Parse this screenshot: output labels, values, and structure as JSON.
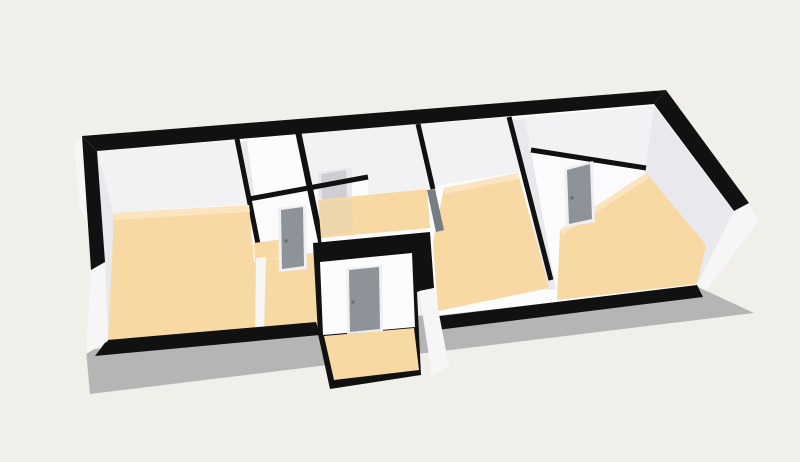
{
  "view": {
    "kind": "3d-floor-plan-render",
    "camera": "perspective-overhead"
  },
  "colors": {
    "background": "#f0efe9",
    "wall_top": "#111111",
    "wall_face": "#fcfcfd",
    "wall_face_lit": "#fbfbfd",
    "wall_shade_light": "#f2f2f5",
    "wall_shade": "#e9e9ed",
    "wall_shade_dark": "#e3e3e7",
    "wall_shade_deep": "#cfcfd3",
    "outer_face": "#f6f6f7",
    "floor": "#f8d9a3",
    "floor_light": "#fbe4c0",
    "floor_dim": "#eed6ab",
    "shadow": "#b5b5b5",
    "door": "#8e939a",
    "door_dark": "#787d84",
    "door_handle": "#6a6f76",
    "door_frame": "#f0f0f2"
  },
  "inventory": {
    "rooms_visible": 7,
    "doors_visible": 5
  }
}
